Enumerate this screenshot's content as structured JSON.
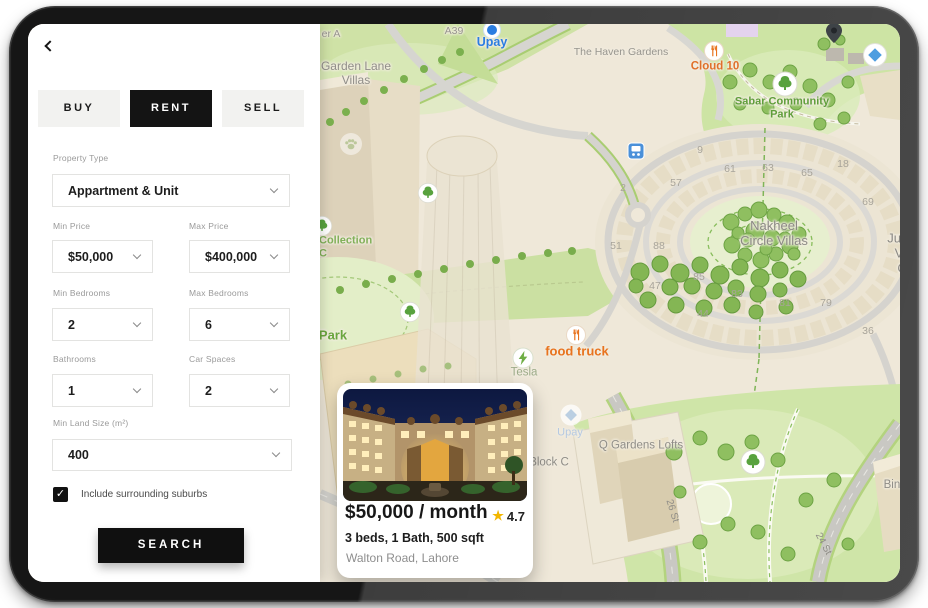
{
  "filter_panel": {
    "tabs": [
      {
        "label": "BUY",
        "active": false
      },
      {
        "label": "RENT",
        "active": true
      },
      {
        "label": "SELL",
        "active": false
      }
    ],
    "fields": {
      "property_type": {
        "label": "Property Type",
        "value": "Appartment & Unit"
      },
      "min_price": {
        "label": "Min Price",
        "value": "$50,000"
      },
      "max_price": {
        "label": "Max Price",
        "value": "$400,000"
      },
      "min_bedrooms": {
        "label": "Min Bedrooms",
        "value": "2"
      },
      "max_bedrooms": {
        "label": "Max Bedrooms",
        "value": "6"
      },
      "bathrooms": {
        "label": "Bathrooms",
        "value": "1"
      },
      "car_spaces": {
        "label": "Car Spaces",
        "value": "2"
      },
      "min_land_size": {
        "label": "Min Land Size (m²)",
        "value": "400"
      }
    },
    "checkbox": {
      "checked": true,
      "check_glyph": "✓",
      "label": "Include surrounding suburbs"
    },
    "search_button": "SEARCH"
  },
  "property_card": {
    "price": "$50,000 / month",
    "rating_star": "★",
    "rating": "4.7",
    "details": "3 beds, 1 Bath, 500 sqft",
    "address": "Walton Road, Lahore"
  },
  "map": {
    "accent_colors": {
      "poi_orange": "#e8731e",
      "poi_green": "#5f9e3a",
      "poi_blue": "#2a7de1",
      "label_gray": "#8f8d87"
    },
    "labels": [
      {
        "name": "road-label-er-a",
        "text": "er A",
        "x": 303,
        "y": 10,
        "cls": "gray-md",
        "interactable": false
      },
      {
        "name": "road-label-a39",
        "text": "A39",
        "x": 426,
        "y": 7,
        "cls": "gray-md",
        "interactable": false
      },
      {
        "name": "upay-pin-icon",
        "icon": "upay",
        "x": 464,
        "y": 6,
        "interactable": true
      },
      {
        "name": "poi-upay",
        "text": "Upay",
        "x": 464,
        "y": 18,
        "cls": "blue-bold",
        "interactable": true
      },
      {
        "name": "area-garden-lane-villas",
        "text": "Garden Lane\nVillas",
        "x": 328,
        "y": 50,
        "cls": "gray-lg",
        "interactable": false
      },
      {
        "name": "area-the-haven-gardens",
        "text": "The Haven Gardens",
        "x": 593,
        "y": 28,
        "cls": "gray-md",
        "interactable": false
      },
      {
        "name": "restaurant-icon-cloud10",
        "icon": "food",
        "x": 686,
        "y": 27,
        "interactable": true
      },
      {
        "name": "poi-cloud-10",
        "text": "Cloud 10",
        "x": 687,
        "y": 43,
        "cls": "orange-bold",
        "interactable": true
      },
      {
        "name": "park-tree-icon-sabar",
        "icon": "tree",
        "x": 757,
        "y": 60,
        "interactable": true
      },
      {
        "name": "poi-sabar-community-park",
        "text": "Sabar Community\nPark",
        "x": 754,
        "y": 84,
        "cls": "green-bold",
        "interactable": true
      },
      {
        "name": "map-pin-icon",
        "icon": "pin",
        "x": 806,
        "y": 9,
        "interactable": true
      },
      {
        "name": "poi-diamond-icon",
        "icon": "diamond",
        "x": 847,
        "y": 31,
        "interactable": true
      },
      {
        "name": "bus-stop-icon",
        "icon": "bus",
        "x": 608,
        "y": 127,
        "interactable": true
      },
      {
        "name": "paw-icon",
        "icon": "paw",
        "x": 323,
        "y": 120,
        "interactable": false
      },
      {
        "name": "house-number",
        "text": "9",
        "x": 672,
        "y": 126,
        "cls": "num",
        "interactable": false
      },
      {
        "name": "house-number",
        "text": "61",
        "x": 702,
        "y": 145,
        "cls": "num",
        "interactable": false
      },
      {
        "name": "house-number",
        "text": "63",
        "x": 740,
        "y": 144,
        "cls": "num",
        "interactable": false
      },
      {
        "name": "house-number",
        "text": "65",
        "x": 779,
        "y": 149,
        "cls": "num",
        "interactable": false
      },
      {
        "name": "house-number",
        "text": "18",
        "x": 815,
        "y": 140,
        "cls": "num",
        "interactable": false
      },
      {
        "name": "house-number",
        "text": "57",
        "x": 648,
        "y": 159,
        "cls": "num",
        "interactable": false
      },
      {
        "name": "house-number",
        "text": "2",
        "x": 595,
        "y": 164,
        "cls": "num",
        "interactable": false
      },
      {
        "name": "house-number",
        "text": "69",
        "x": 840,
        "y": 178,
        "cls": "num",
        "interactable": false
      },
      {
        "name": "house-number",
        "text": "51",
        "x": 588,
        "y": 222,
        "cls": "num",
        "interactable": false
      },
      {
        "name": "house-number",
        "text": "88",
        "x": 631,
        "y": 222,
        "cls": "num",
        "interactable": false
      },
      {
        "name": "house-number",
        "text": "85",
        "x": 671,
        "y": 253,
        "cls": "num",
        "interactable": false
      },
      {
        "name": "house-number",
        "text": "47",
        "x": 627,
        "y": 262,
        "cls": "num",
        "interactable": false
      },
      {
        "name": "house-number",
        "text": "83",
        "x": 709,
        "y": 270,
        "cls": "num",
        "interactable": false
      },
      {
        "name": "house-number",
        "text": "44",
        "x": 675,
        "y": 290,
        "cls": "num",
        "interactable": false
      },
      {
        "name": "house-number",
        "text": "81",
        "x": 757,
        "y": 279,
        "cls": "num",
        "interactable": false
      },
      {
        "name": "house-number",
        "text": "79",
        "x": 798,
        "y": 279,
        "cls": "num",
        "interactable": false
      },
      {
        "name": "house-number",
        "text": "36",
        "x": 840,
        "y": 307,
        "cls": "num",
        "interactable": false
      },
      {
        "name": "area-nakheel-circle-villas",
        "text": "Nakheel\nCircle Villas",
        "x": 746,
        "y": 210,
        "cls": "gray-xl",
        "interactable": false
      },
      {
        "name": "area-jumeirah-village-circle",
        "text": "Jumeirah\nVillage\nCircle",
        "x": 886,
        "y": 230,
        "cls": "gray-xl",
        "interactable": false
      },
      {
        "name": "poi-collection-icon",
        "icon": "tree-sm",
        "x": 294,
        "y": 202,
        "interactable": true
      },
      {
        "name": "poi-collection",
        "text": "Collection\nC",
        "x": 291,
        "y": 223,
        "cls": "green-md al",
        "interactable": true
      },
      {
        "name": "park-tree-icon-a",
        "icon": "tree-sm",
        "x": 400,
        "y": 169,
        "interactable": true
      },
      {
        "name": "park-tree-icon-b",
        "icon": "tree-sm",
        "x": 382,
        "y": 288,
        "interactable": true
      },
      {
        "name": "poi-park",
        "text": "Park",
        "x": 305,
        "y": 312,
        "cls": "green-bold-lg",
        "interactable": true
      },
      {
        "name": "restaurant-icon-food-truck",
        "icon": "food",
        "x": 548,
        "y": 311,
        "interactable": true
      },
      {
        "name": "poi-food-truck",
        "text": "food truck",
        "x": 549,
        "y": 328,
        "cls": "orange-bold-lg",
        "interactable": true
      },
      {
        "name": "ev-charger-icon-tesla",
        "icon": "ev",
        "x": 495,
        "y": 334,
        "interactable": true
      },
      {
        "name": "poi-tesla",
        "text": "Tesla",
        "x": 496,
        "y": 349,
        "cls": "sage-md",
        "interactable": true
      },
      {
        "name": "upay-faded-icon",
        "icon": "diamond-faded",
        "x": 543,
        "y": 391,
        "interactable": true
      },
      {
        "name": "poi-upay-2",
        "text": "Upay",
        "x": 542,
        "y": 409,
        "cls": "faded-blue",
        "interactable": true
      },
      {
        "name": "area-q-gardens-lofts",
        "text": "Q Gardens Lofts",
        "x": 613,
        "y": 422,
        "cls": "gray-md-lg",
        "interactable": false
      },
      {
        "name": "area-block-c",
        "text": "Block C",
        "x": 521,
        "y": 439,
        "cls": "gray-md-lg",
        "interactable": false
      },
      {
        "name": "park-tree-icon-south",
        "icon": "tree",
        "x": 725,
        "y": 438,
        "interactable": true
      },
      {
        "name": "area-binghatti",
        "text": "Binghatti C",
        "x": 878,
        "y": 468,
        "cls": "gray-md-lg",
        "interactable": false
      },
      {
        "name": "road-label-26-st",
        "text": "26 St",
        "x": 644,
        "y": 487,
        "cls": "road-rot",
        "rot": 73,
        "interactable": false
      },
      {
        "name": "road-label-24-st",
        "text": "24 St",
        "x": 795,
        "y": 520,
        "cls": "road-rot",
        "rot": 62,
        "interactable": false
      }
    ]
  }
}
